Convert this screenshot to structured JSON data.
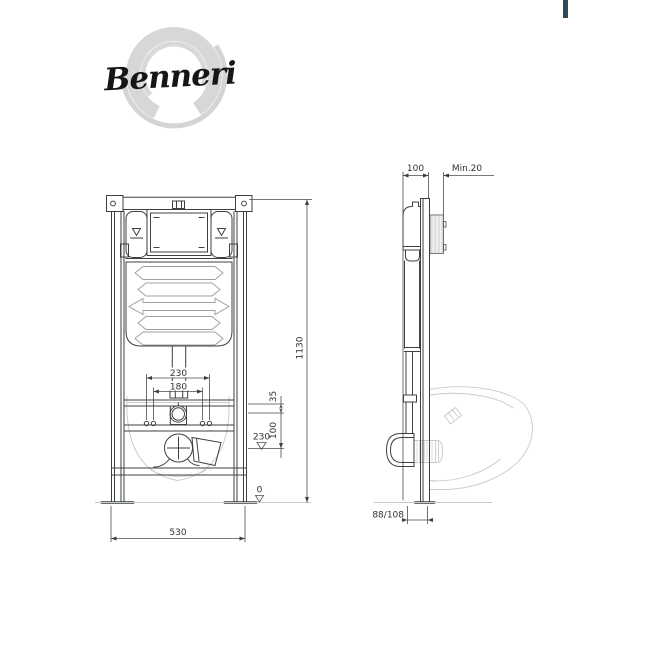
{
  "brand": {
    "name": "Benneri"
  },
  "accent": {
    "color": "#2d4a59"
  },
  "front_view": {
    "dims": {
      "pipe_spacing_outer": "230",
      "pipe_spacing_inner": "180",
      "frame_width": "530",
      "frame_height": "1130",
      "offset_35": "35",
      "offset_100": "100",
      "drain_height": "230",
      "floor_level": "0"
    }
  },
  "side_view": {
    "dims": {
      "frame_depth": "100",
      "wall_min": "Min.20",
      "outlet_offset": "88/108"
    }
  }
}
